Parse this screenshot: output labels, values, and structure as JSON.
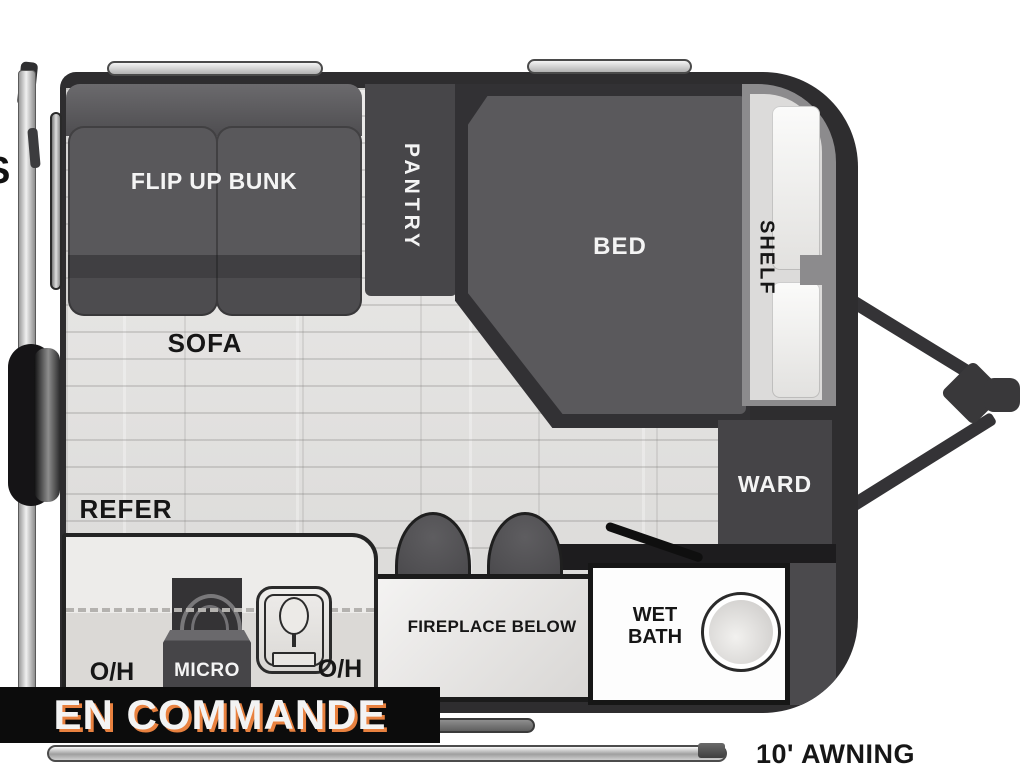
{
  "banner": {
    "text": "EN COMMANDE"
  },
  "floorplan": {
    "furniture_labels": {
      "flip_up_bunk": "FLIP UP BUNK",
      "pantry": "PANTRY",
      "bed": "BED",
      "shelf": "SHELF",
      "sofa": "SOFA",
      "refer": "REFER",
      "ward": "WARD",
      "fireplace": "FIREPLACE BELOW",
      "wet_bath_line1": "WET",
      "wet_bath_line2": "BATH",
      "micro": "MICRO",
      "overhead_left": "O/H",
      "overhead_right": "O/H"
    },
    "exterior_labels": {
      "awning": "10' AWNING",
      "left_edge_letter": "S"
    },
    "colors": {
      "body_wall": "#2e2d2f",
      "floor": "#e4e3e2",
      "dark_furniture": "#4a494c",
      "shelf_band": "#8c8b8d",
      "banner_bg": "#0c0c0c",
      "banner_text": "#f3f3f3",
      "banner_shadow": "#e8813f"
    }
  }
}
